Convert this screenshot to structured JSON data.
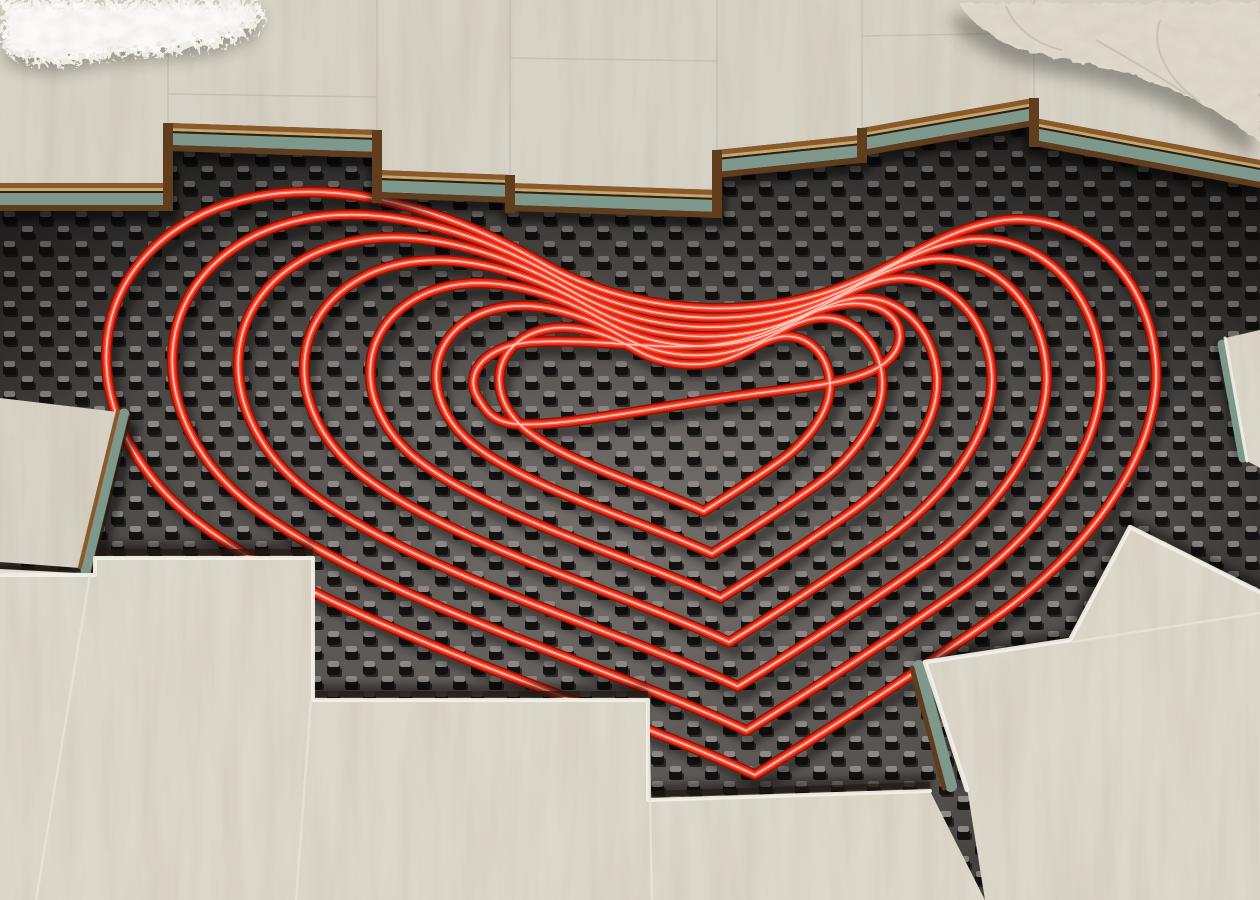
{
  "scene": {
    "description": "Photorealistic 3D render of an underfloor heating installation: a red heating pipe laid in a heart-shaped spiral on a black studded insulation panel, partially covered by pale whitewashed-oak laminate planks removed in a staircase pattern, with a white shaggy rug at the top left and a cream knitted pillow at the top right.",
    "objects": [
      {
        "id": "heating-panel",
        "label": "black studded pipe-mounting insulation panel"
      },
      {
        "id": "heating-pipe",
        "label": "red PEX heating pipe"
      },
      {
        "id": "laminate-flooring",
        "label": "whitewashed oak laminate planks, partially installed"
      },
      {
        "id": "plank-cross-section",
        "label": "plank edge layers: wood veneer, HDF core, green underlay"
      },
      {
        "id": "shag-rug",
        "label": "white shaggy rug"
      },
      {
        "id": "knitted-pillow",
        "label": "cream knitted pillow"
      }
    ],
    "pipe": {
      "layout": "heart-shaped spiral",
      "loops": 7
    }
  },
  "colors": {
    "panel_light": "#75706c",
    "panel_mid": "#4e4a47",
    "panel_dark": "#23201f",
    "stud_dark": "#141211",
    "stud_face": "#8d8885",
    "pipe_shadow": "#000000",
    "pipe_dark": "#8f1104",
    "pipe_body": "#e22712",
    "pipe_core": "#ff5038",
    "pipe_highlight": "#ffd8cc",
    "wood_top": "#d6d2c5",
    "wood_bottom": "#dcd8cb",
    "edge_brown": "#8a5a2b",
    "edge_ply": "#c9a76c",
    "edge_dark": "#2e2014",
    "edge_teal": "#7e998c",
    "edge_brown_dark": "#5f3d1d",
    "gap_white": "#f3f0e8",
    "rug": "#efece4",
    "pillow": "#ded9cb"
  }
}
